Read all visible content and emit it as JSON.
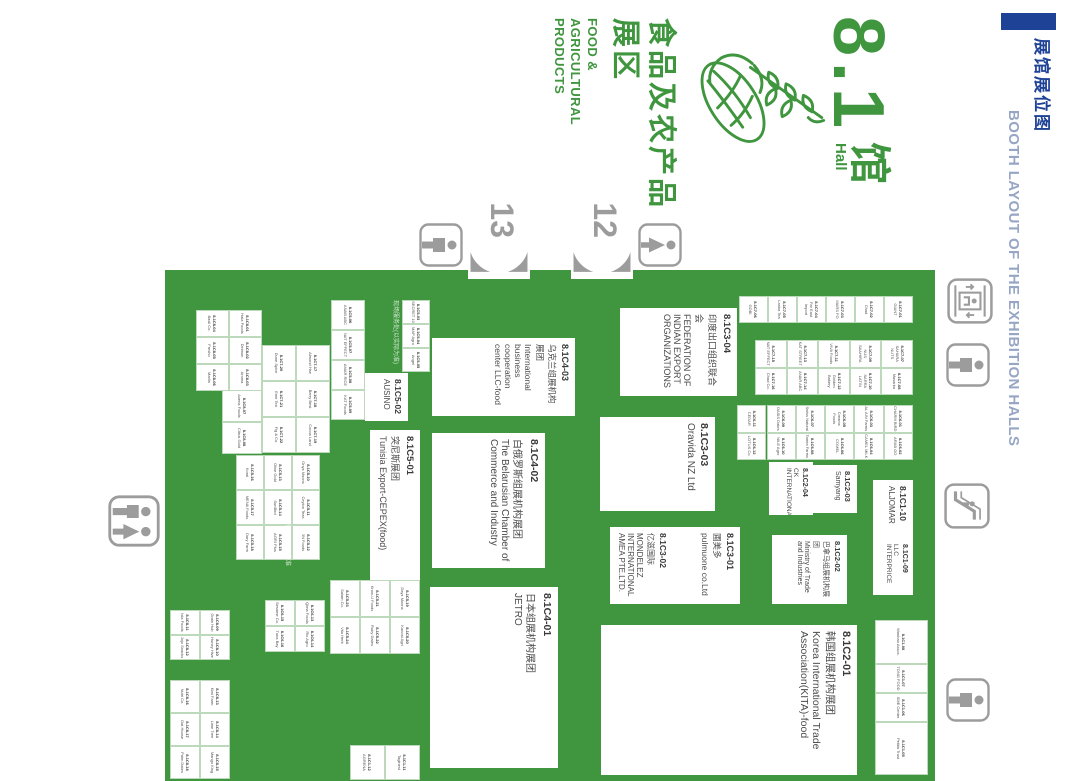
{
  "header": {
    "accent_color": "#1E4296",
    "title_cn": "展馆展位图",
    "title_en": "BOOTH LAYOUT OF THE EXHIBITION HALLS"
  },
  "hall": {
    "number": "8.1",
    "suffix_cn": "馆",
    "suffix_en": "Hall",
    "zone_cn_line1": "食品及农产品",
    "zone_cn_line2": "展区",
    "zone_en_line1": "FOOD &",
    "zone_en_line2": "AGRICULTURAL",
    "zone_en_line3": "PRODUCTS",
    "green": "#3F963E"
  },
  "map": {
    "bg": "#3F963E",
    "x": 270,
    "y": 145,
    "w": 511,
    "h": 770,
    "gates": [
      {
        "label": "12",
        "y": 447,
        "h": 62
      },
      {
        "label": "13",
        "y": 550,
        "h": 62
      }
    ],
    "icons": [
      {
        "type": "elevator",
        "x": 278,
        "y": 87,
        "s": 46
      },
      {
        "type": "restroom-male",
        "x": 343,
        "y": 90,
        "s": 44
      },
      {
        "type": "escalator",
        "x": 483,
        "y": 90,
        "s": 46
      },
      {
        "type": "restroom-male",
        "x": 678,
        "y": 90,
        "s": 44
      },
      {
        "type": "restroom-female",
        "x": 223,
        "y": 398,
        "s": 44
      },
      {
        "type": "restroom-male",
        "x": 223,
        "y": 617,
        "s": 44
      },
      {
        "type": "restroom-double",
        "x": 495,
        "y": 920,
        "s": 52
      }
    ],
    "notes": [
      {
        "text": "现场服务处(以实际为准)",
        "x": 300,
        "y": 682,
        "w": 70
      },
      {
        "text": "具体展位信息以现场为准",
        "x": 500,
        "y": 790,
        "w": 72
      }
    ],
    "booths_large": [
      {
        "code": "8.1C3-04",
        "cn": "印度出口组织联合会",
        "en": "FEDERATION OF INDIAN EXPORT ORGANIZATIONS",
        "x": 308,
        "y": 343,
        "w": 88,
        "h": 117,
        "fs": 9
      },
      {
        "code": "8.1C4-03",
        "cn": "乌克兰组展机构展团",
        "en": "International business cooperation center LLC-food",
        "x": 338,
        "y": 505,
        "w": 78,
        "h": 143,
        "fs": 8.5
      },
      {
        "code": "8.1C3-03",
        "cn": "",
        "en": "Oravida NZ Ltd",
        "x": 417,
        "y": 365,
        "w": 94,
        "h": 115,
        "fs": 10
      },
      {
        "code": "8.1C3-01",
        "cn": "圃美多",
        "en": "pulmuone co.Ltd",
        "x": 527,
        "y": 340,
        "w": 77,
        "h": 67,
        "fs": 8.5
      },
      {
        "code": "8.1C3-02",
        "cn": "亿滋国际",
        "en": "MONDELEZ INTERNATIONAL AMEA PTE.LTD.",
        "x": 527,
        "y": 407,
        "w": 77,
        "h": 63,
        "fs": 8
      },
      {
        "code": "8.1C2-03",
        "cn": "",
        "en": "Samyang",
        "x": 465,
        "y": 223,
        "w": 48,
        "h": 44,
        "fs": 7
      },
      {
        "code": "8.1C2-04",
        "cn": "",
        "en": "CK INTERNATIONAL",
        "x": 462,
        "y": 267,
        "w": 53,
        "h": 44,
        "fs": 6.5
      },
      {
        "code": "8.1C2-02",
        "cn": "巴拿马组展机构展团",
        "en": "Ministry of Trade and Industries",
        "x": 535,
        "y": 233,
        "w": 69,
        "h": 75,
        "fs": 7
      },
      {
        "code": "8.1C1-10",
        "cn": "",
        "en": "ALJOMAR",
        "x": 480,
        "y": 167,
        "w": 58,
        "h": 40,
        "fs": 8
      },
      {
        "code": "8.1C1-09",
        "cn": "",
        "en": "LLC INTERPRICE",
        "x": 538,
        "y": 167,
        "w": 57,
        "h": 40,
        "fs": 6.5
      },
      {
        "code": "8.1C2-01",
        "cn": "韩国组展机构展团",
        "en": "Korea International Trade Association(KITA)-food",
        "x": 625,
        "y": 223,
        "w": 150,
        "h": 256,
        "fs": 10.5
      },
      {
        "code": "8.1C4-02",
        "cn": "白俄罗斯组展机构展团",
        "en": "The Belarusian Chamber of Commerce and Industry",
        "x": 433,
        "y": 535,
        "w": 135,
        "h": 113,
        "fs": 10
      },
      {
        "code": "8.1C5-01",
        "cn": "突尼斯展团",
        "en": "Tunisia Export-CEPEX(food)",
        "x": 430,
        "y": 660,
        "w": 150,
        "h": 50,
        "fs": 9
      },
      {
        "code": "8.1C4-01",
        "cn": "日本组展机构展团",
        "en": "JETRO",
        "x": 587,
        "y": 522,
        "w": 181,
        "h": 128,
        "fs": 10
      },
      {
        "code": "8.1C5-02",
        "cn": "",
        "en": "AUSINO",
        "x": 373,
        "y": 672,
        "w": 48,
        "h": 43,
        "fs": 8
      }
    ],
    "clusters": [
      {
        "name": "col-a",
        "x": 296,
        "y": 167,
        "cw": 27,
        "ch": 29,
        "cols": 1,
        "cells": [
          "8.1C7-01|GIANT",
          "8.1C7-02|Chad",
          "8.1C7-03|MARS FO",
          "8.1C7-04|Far East Import",
          "8.1C7-05|Lanka Tea",
          "8.1C7-06|GOBI"
        ]
      },
      {
        "name": "col-b",
        "x": 340,
        "y": 167,
        "cw": 27.5,
        "ch": 31.5,
        "cols": 2,
        "cells": [
          "8.1C7-07|SAHARA NUTS",
          "8.1C7-08|Masarka",
          "8.1C7-09|NUS SAAHIRA",
          "8.1C7-10|SARRA LATIN",
          "8.1C7-11|VIVA Foods",
          "8.1C7-12|Golden Bakery",
          "8.1C7-13|KAT STREET",
          "8.1C7-14|ANAR ABC",
          "8.1C7-15|NAT EFFECT",
          "8.1C7-16|Chad Co."
        ]
      },
      {
        "name": "col-c",
        "x": 405,
        "y": 167,
        "cw": 27.5,
        "ch": 29.3,
        "cols": 2,
        "cells": [
          "8.1C6-01|CHARM BIRD",
          "8.1C6-02|ARAB GO",
          "8.1C6-03|AL AIN Farms",
          "8.1C6-04|CAMEL MILK",
          "8.1C6-05|Creams Foods",
          "8.1C6-06|COMEL",
          "8.1C6-07|Swiss Natural",
          "8.1C6-08|Tamra Farms",
          "8.1C6-09|OASIS Dates",
          "8.1C6-10|NILE Agro",
          "8.1C6-11|CEDAR",
          "8.1C6-12|LOTUS Co."
        ]
      },
      {
        "name": "row-top-right",
        "x": 620,
        "y": 152,
        "row": true,
        "h": 53,
        "widths": [
          44,
          29,
          29,
          53
        ],
        "cells": [
          "8.1C1-08|Wanbao Assoc.",
          "8.1C1-07|TONG FOOD",
          "8.1C1-06|SME Center",
          "8.1C1-05|Petitia Trust"
        ]
      },
      {
        "name": "above-ausino",
        "x": 300,
        "y": 650,
        "cw": 24,
        "ch": 28,
        "cols": 3,
        "cells": [
          "8.1C5-03|SECRET 10",
          "8.1C5-04|MAP Agro",
          "8.1C5-05|Angel"
        ]
      },
      {
        "name": "below-ausino",
        "x": 300,
        "y": 715,
        "cw": 30,
        "ch": 34,
        "cols": 4,
        "cells": [
          "8.1C5-06|ANAB ABC",
          "8.1C5-07|NAT EFFECT",
          "8.1C5-08|AMAR RICE",
          "8.1C5-09|KAT Foods"
        ]
      },
      {
        "name": "g1",
        "x": 455,
        "y": 760,
        "cw": 35,
        "ch": 28,
        "cols": 3,
        "cells": [
          "8.1C5-10|Onyx Moons",
          "8.1C5-11|Ceylon Teas",
          "8.1C5-12|3N Foods",
          "8.1C5-13|Olive Gold",
          "8.1C5-14|SunBird",
          "8.1C5-15|AGRI Plus",
          "8.1C5-16|Koral",
          "8.1C5-17|MENA Foods",
          "8.1C5-18|Dary Farm"
        ]
      },
      {
        "name": "g2",
        "x": 580,
        "y": 660,
        "cw": 37,
        "ch": 30,
        "cols": 2,
        "cells": [
          "8.1C5-19|Dayz Moons",
          "8.1C5-20|Kanost Agri",
          "8.1C5-21|Krow-U Foods",
          "8.1C5-22|Ruby Dates",
          "8.1C5-23|Salam Co.",
          "8.1C5-24|Vita Herb"
        ]
      },
      {
        "name": "g3",
        "x": 310,
        "y": 818,
        "cw": 27,
        "ch": 33,
        "cols": 3,
        "cells": [
          "8.1C8-01|Hala Foods",
          "8.1C8-02|Delmon",
          "8.1C8-03|Aroma",
          "8.1C8-04|Basil Co.",
          "8.1C8-05|Fresho",
          "8.1C8-06|Marlin"
        ]
      },
      {
        "name": "g4",
        "x": 390,
        "y": 818,
        "cw": 32,
        "ch": 40,
        "cols": 2,
        "cells": [
          "8.1C8-07|Avena Foods",
          "8.1C8-08|Citrus Gold"
        ]
      },
      {
        "name": "g6",
        "x": 345,
        "y": 750,
        "cw": 36,
        "ch": 34,
        "cols": 3,
        "cells": [
          "8.1C7-17|Almond Hse",
          "8.1C7-18|Berry Best",
          "8.1C7-19|Cocoa Land",
          "8.1C7-20|Dune Spice",
          "8.1C7-21|Emir Tea",
          "8.1C7-22|Fig & Co."
        ]
      },
      {
        "name": "g7",
        "x": 610,
        "y": 850,
        "cw": 25,
        "ch": 30,
        "cols": 2,
        "cells": [
          "8.1C8-09|Grain Hub",
          "8.1C8-10|Honey Hive",
          "8.1C8-11|Isla Foods",
          "8.1C8-12|Jojo Snacks"
        ]
      },
      {
        "name": "g8",
        "x": 680,
        "y": 850,
        "cw": 33,
        "ch": 30,
        "cols": 3,
        "cells": [
          "8.1C8-13|Kiwi Farm",
          "8.1C8-14|Lime Tree",
          "8.1C8-15|Mango King",
          "8.1C8-16|Nutri Co.",
          "8.1C8-17|Oat House",
          "8.1C8-18|Palm Dates"
        ]
      },
      {
        "name": "g9",
        "x": 745,
        "y": 660,
        "cw": 35,
        "ch": 35,
        "cols": 1,
        "cells": [
          "8.1C1-11|Taginest",
          "8.1C1-12|AGRENA"
        ]
      },
      {
        "name": "g10",
        "x": 600,
        "y": 755,
        "cw": 26,
        "ch": 30,
        "cols": 2,
        "cells": [
          "8.1C6-13|Qima Foods",
          "8.1C6-14|Rio Agro",
          "8.1C6-15|Sesame Co.",
          "8.1C6-16|Tuna Bay"
        ]
      }
    ]
  }
}
